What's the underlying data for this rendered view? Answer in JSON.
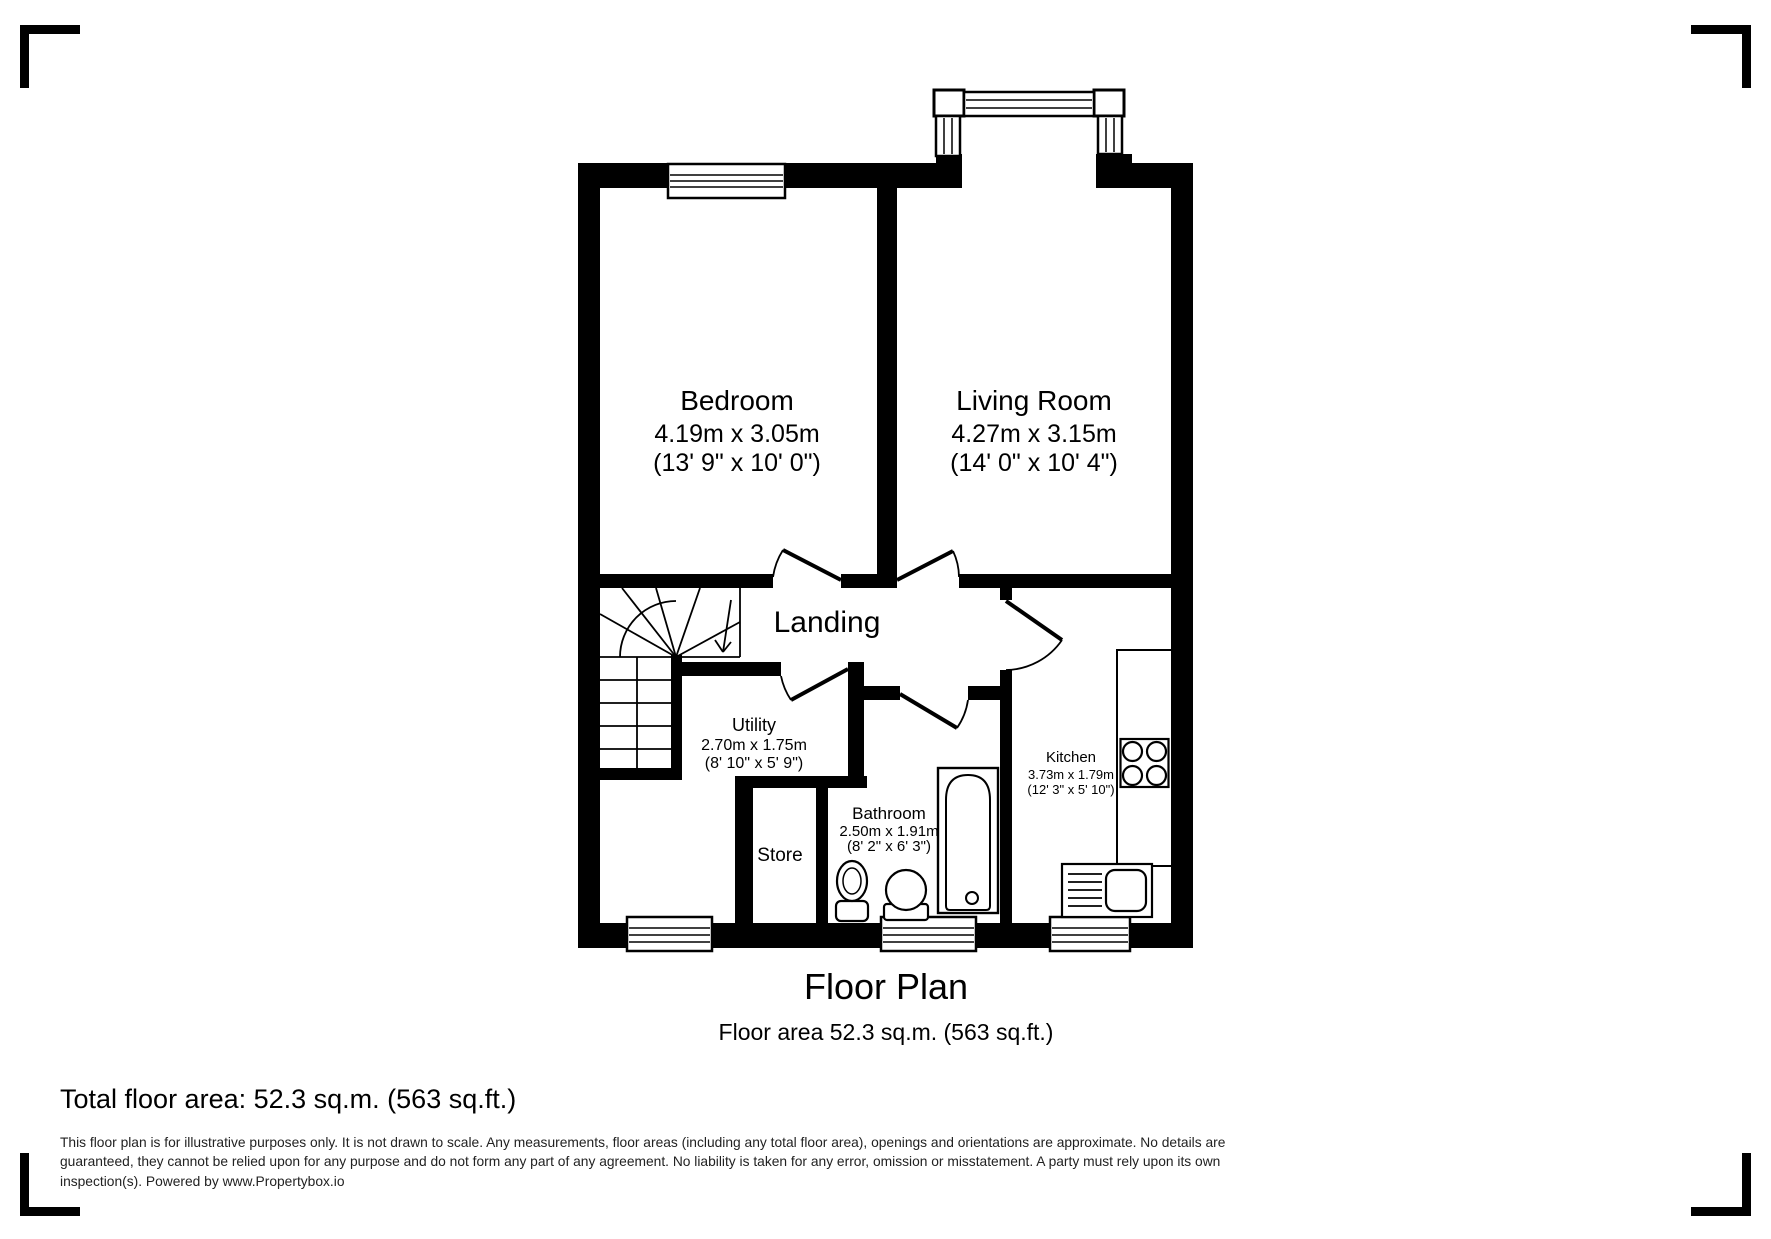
{
  "plan": {
    "rooms": {
      "bedroom": {
        "name": "Bedroom",
        "metric": "4.19m x 3.05m",
        "imperial": "(13' 9\" x 10' 0\")"
      },
      "living": {
        "name": "Living Room",
        "metric": "4.27m x 3.15m",
        "imperial": "(14' 0\" x 10' 4\")"
      },
      "landing": {
        "name": "Landing"
      },
      "utility": {
        "name": "Utility",
        "metric": "2.70m x 1.75m",
        "imperial": "(8' 10\" x 5' 9\")"
      },
      "kitchen": {
        "name": "Kitchen",
        "metric": "3.73m x 1.79m",
        "imperial": "(12' 3\" x 5' 10\")"
      },
      "bathroom": {
        "name": "Bathroom",
        "metric": "2.50m x 1.91m",
        "imperial": "(8' 2\" x 6' 3\")"
      },
      "store": {
        "name": "Store"
      }
    },
    "colors": {
      "wall": "#000000",
      "background": "#ffffff",
      "disclaimer_text": "#222222"
    }
  },
  "footer": {
    "title": "Floor Plan",
    "subtitle": "Floor area 52.3 sq.m. (563 sq.ft.)",
    "total_area": "Total floor area: 52.3 sq.m. (563 sq.ft.)",
    "disclaimer": "This floor plan is for illustrative purposes only. It is not drawn to scale. Any measurements, floor areas (including any total floor area), openings and orientations are approximate. No details are guaranteed, they cannot be relied upon for any purpose and do not form any part of any agreement. No liability is taken for any error, omission or misstatement. A party must rely upon its own inspection(s). Powered by www.Propertybox.io"
  }
}
